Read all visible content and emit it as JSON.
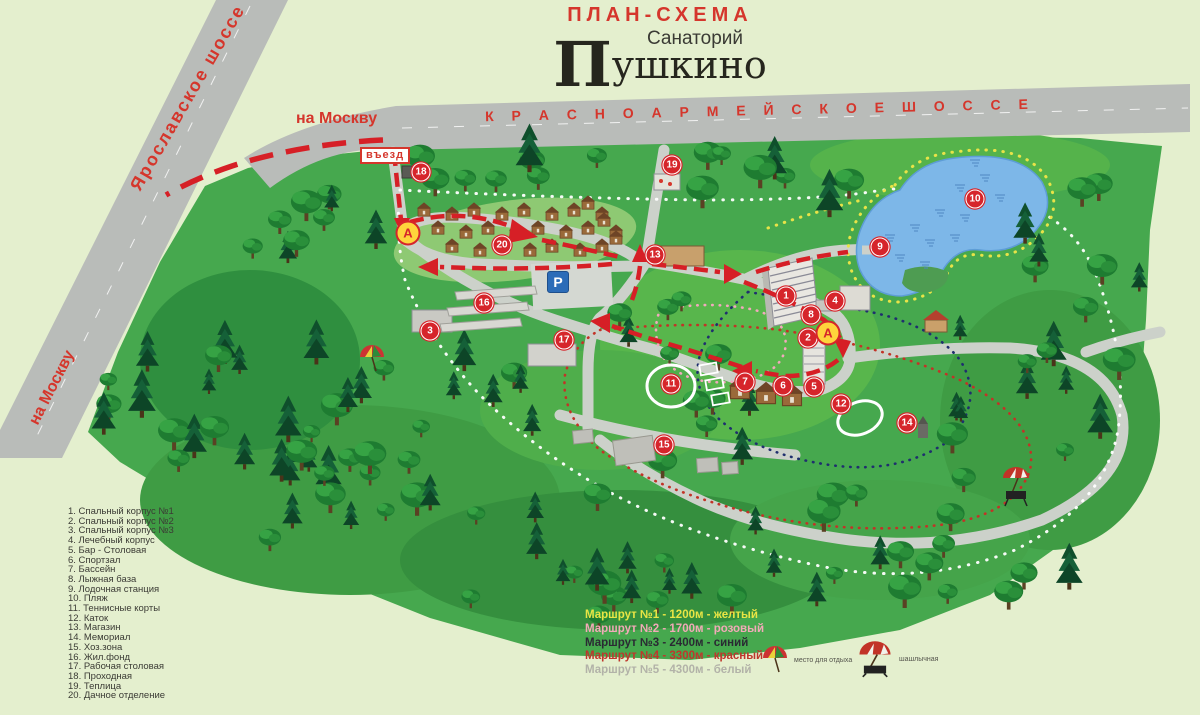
{
  "title": {
    "scheme": "ПЛАН-СХЕМА",
    "subtitle": "Санаторий",
    "name_first": "П",
    "name_rest": "ушкино"
  },
  "road_labels": {
    "top_highway": "К Р А С Н О А Р М Е Й С К О Е     Ш О С С Е",
    "diagonal_highway": "Ярославское шоссе",
    "to_moscow_top": "на Москву",
    "to_moscow_bottom": "на Москву",
    "entrance": "въезд"
  },
  "map": {
    "bus_stop_label": "А",
    "parking_label": "Р",
    "markers": [
      {
        "n": "1",
        "x": 786,
        "y": 296
      },
      {
        "n": "2",
        "x": 808,
        "y": 338
      },
      {
        "n": "3",
        "x": 430,
        "y": 331
      },
      {
        "n": "4",
        "x": 835,
        "y": 301
      },
      {
        "n": "5",
        "x": 814,
        "y": 387
      },
      {
        "n": "6",
        "x": 783,
        "y": 386
      },
      {
        "n": "7",
        "x": 745,
        "y": 382
      },
      {
        "n": "8",
        "x": 811,
        "y": 315
      },
      {
        "n": "9",
        "x": 880,
        "y": 247
      },
      {
        "n": "10",
        "x": 975,
        "y": 199
      },
      {
        "n": "11",
        "x": 671,
        "y": 384
      },
      {
        "n": "12",
        "x": 841,
        "y": 404
      },
      {
        "n": "13",
        "x": 655,
        "y": 255
      },
      {
        "n": "14",
        "x": 907,
        "y": 423
      },
      {
        "n": "15",
        "x": 664,
        "y": 445
      },
      {
        "n": "16",
        "x": 484,
        "y": 303
      },
      {
        "n": "17",
        "x": 564,
        "y": 340
      },
      {
        "n": "18",
        "x": 421,
        "y": 172
      },
      {
        "n": "19",
        "x": 672,
        "y": 165
      },
      {
        "n": "20",
        "x": 502,
        "y": 245
      }
    ],
    "bus_stops": [
      {
        "x": 408,
        "y": 233
      },
      {
        "x": 828,
        "y": 333
      }
    ],
    "parking": {
      "x": 558,
      "y": 282
    }
  },
  "legend": {
    "items": [
      {
        "n": "1.",
        "label": "Спальный корпус №1"
      },
      {
        "n": "2.",
        "label": "Спальный корпус №2"
      },
      {
        "n": "3.",
        "label": "Спальный корпус №3"
      },
      {
        "n": "4.",
        "label": "Лечебный корпус"
      },
      {
        "n": "5.",
        "label": "Бар - Столовая"
      },
      {
        "n": "6.",
        "label": "Спортзал"
      },
      {
        "n": "7.",
        "label": "Бассейн"
      },
      {
        "n": "8.",
        "label": "Лыжная база"
      },
      {
        "n": "9.",
        "label": "Лодочная станция"
      },
      {
        "n": "10.",
        "label": "Пляж"
      },
      {
        "n": "11.",
        "label": "Теннисные корты"
      },
      {
        "n": "12.",
        "label": "Каток"
      },
      {
        "n": "13.",
        "label": "Магазин"
      },
      {
        "n": "14.",
        "label": "Мемориал"
      },
      {
        "n": "15.",
        "label": "Хоз.зона"
      },
      {
        "n": "16.",
        "label": "Жил.фонд"
      },
      {
        "n": "17.",
        "label": "Рабочая столовая"
      },
      {
        "n": "18.",
        "label": "Проходная"
      },
      {
        "n": "19.",
        "label": "Теплица"
      },
      {
        "n": "20.",
        "label": "Дачное отделение"
      }
    ]
  },
  "route_legend": [
    {
      "label": "Маршрут №1 - 1200м - желтый",
      "color": "#e9e545"
    },
    {
      "label": "Маршрут №2 - 1700м - розовый",
      "color": "#f2aab8"
    },
    {
      "label": "Маршрут №3 - 2400м - синий",
      "color": "#2a2a33"
    },
    {
      "label": "Маршрут №4 - 3300м - красный",
      "color": "#bf362c"
    },
    {
      "label": "Маршрут №5 - 4300м - белый",
      "color": "#b2b2a8"
    }
  ],
  "symbols_legend": [
    {
      "icon": "umbrella-icon",
      "label": "место для отдыха"
    },
    {
      "icon": "bbq-icon",
      "label": "шашлычная"
    }
  ],
  "colors": {
    "background": "#e4efce",
    "forest": "#46a84e",
    "road": "#b9bcb9",
    "path": "#ccd1ca",
    "lake": "#7db7e8",
    "route_red": "#d61f26",
    "marker_red": "#d6252b",
    "bus_yellow": "#ffd43c",
    "parking_blue": "#2b6cb8"
  }
}
